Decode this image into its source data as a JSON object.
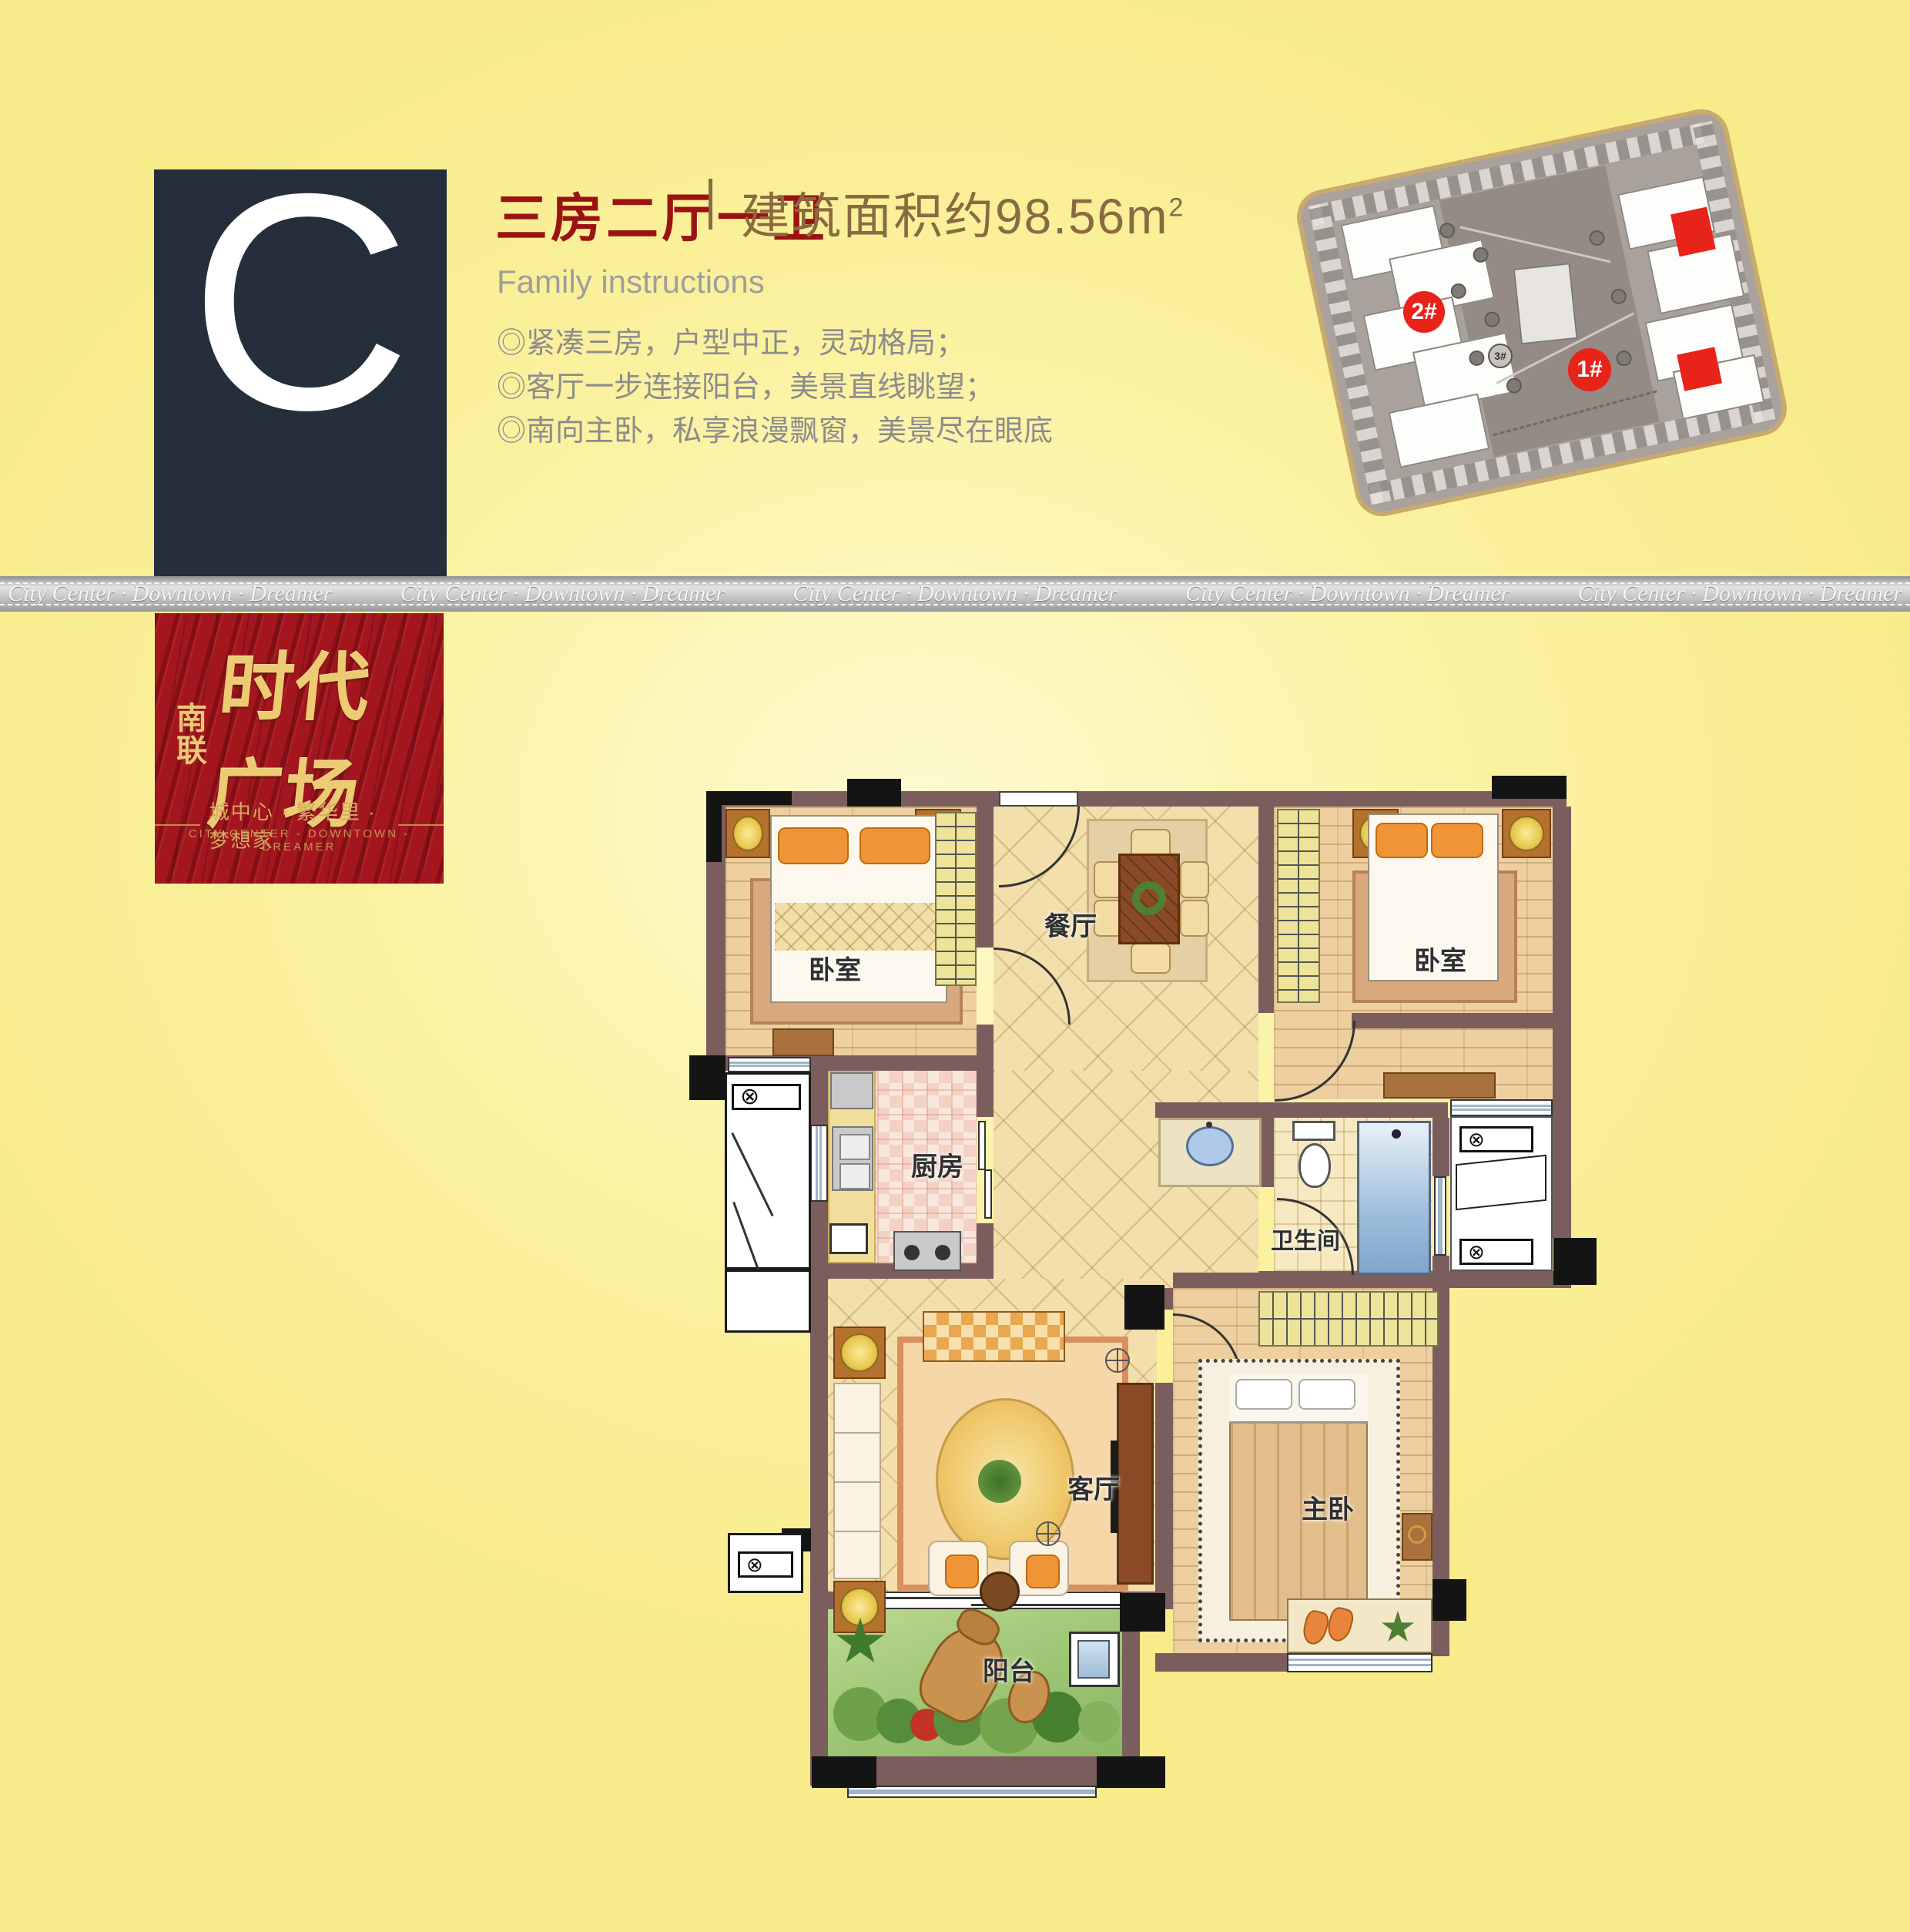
{
  "type_box": {
    "letter": "C",
    "category": "[户型]",
    "units": "1#楼2单元/6单元"
  },
  "header": {
    "title": "三房二厅一卫",
    "area": "建筑面积约98.56m",
    "area_sup": "2",
    "subtitle": "Family instructions"
  },
  "features": [
    "◎紧凑三房，户型中正，灵动格局；",
    "◎客厅一步连接阳台，美景直线眺望；",
    "◎南向主卧，私享浪漫飘窗，美景尽在眼底"
  ],
  "ribbon": {
    "segment": "City Center · Downtown · Dreamer"
  },
  "logo": {
    "prefix_top": "南",
    "prefix_bottom": "联",
    "name": "时代广场",
    "tagline_cn": "城中心 · 繁华里 · 梦想家",
    "tagline_en": "CITY CENTER - DOWNTOWN - DREAMER"
  },
  "site_map": {
    "badges": [
      {
        "label": "2#"
      },
      {
        "label": "1#"
      },
      {
        "label": "3#"
      }
    ],
    "highlight_color": "#E8231A"
  },
  "floor_plan": {
    "rooms": [
      {
        "name": "bedroom-left",
        "label": "卧室"
      },
      {
        "name": "dining",
        "label": "餐厅"
      },
      {
        "name": "bedroom-right",
        "label": "卧室"
      },
      {
        "name": "kitchen",
        "label": "厨房"
      },
      {
        "name": "bathroom",
        "label": "卫生间"
      },
      {
        "name": "living",
        "label": "客厅"
      },
      {
        "name": "master-bedroom",
        "label": "主卧"
      },
      {
        "name": "balcony",
        "label": "阳台"
      }
    ]
  },
  "icons": {
    "unit_marker": "⊗"
  },
  "colors": {
    "accent_red": "#9B1212",
    "navy": "#252F3B",
    "gold": "#ECCB72",
    "wall": "#7B5D5E",
    "bg_yellow": "#FBF2A2"
  }
}
